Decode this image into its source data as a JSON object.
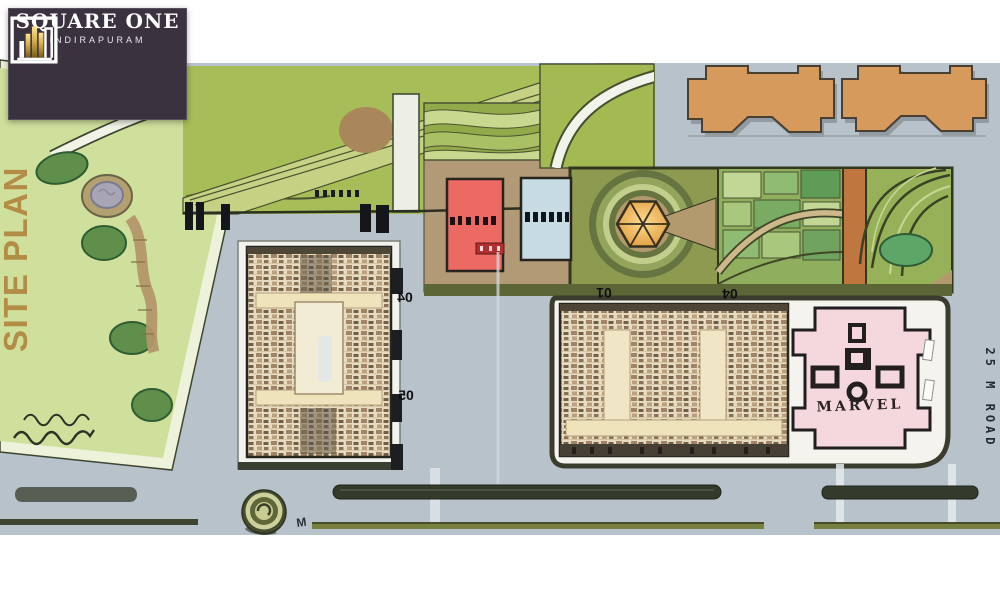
{
  "logo": {
    "title": "SQUARE ONE",
    "subtitle": "INDIRAPURAM"
  },
  "site_plan": {
    "title": "SITE PLAN"
  },
  "labels": {
    "marvel": "MARVEL",
    "tower_a": "04",
    "tower_b": "05",
    "tower_c": "01",
    "tower_d": "04",
    "road": "25 M ROAD",
    "entry_marker": "M"
  },
  "colors": {
    "road_gray": "#b7c2cb",
    "park_green": "#cfe09c",
    "lawn_green": "#a6bd58",
    "strip_olive": "#8e9a50",
    "tan": "#b29a76",
    "red_building": "#ed6a64",
    "blue_building": "#c7dbe3",
    "orange_building": "#d79a5d",
    "pink_building": "#f5d7de",
    "beige_building": "#e7dcc2",
    "logo_bg": "#3a323f",
    "gold_accent": "#d4af4e"
  }
}
